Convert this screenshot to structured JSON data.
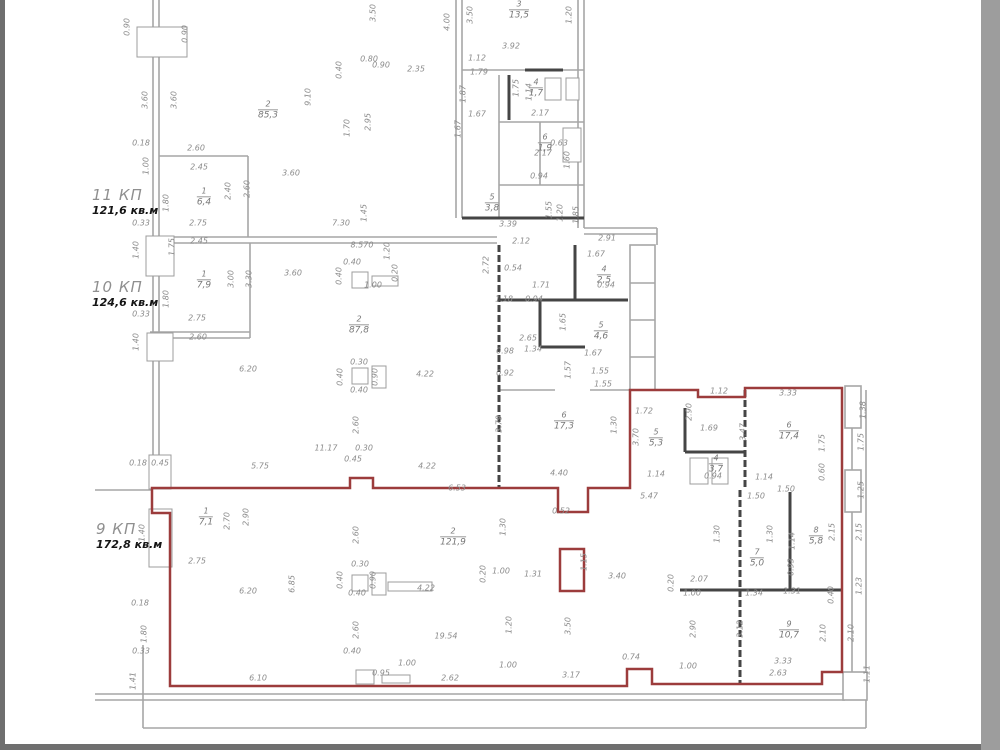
{
  "drawing": {
    "type": "floor-plan",
    "units": "m"
  },
  "colors": {
    "red_wall": "#9c3c3c",
    "gray_wall": "#a6a6a6",
    "black_wall": "#454545",
    "dim_text": "#8b8b8b",
    "room_text": "#787878",
    "apartment_label": "#8f8f8f",
    "apartment_area_text": "#151515",
    "left_bar": "#6f6f6f",
    "right_bar": "#9d9d9d",
    "bottom_bar": "#6f6f6f"
  },
  "apartments": [
    {
      "name": "11 КП",
      "area": "121,6 кв.м",
      "x": 92,
      "y": 186
    },
    {
      "name": "10 КП",
      "area": "124,6 кв.м",
      "x": 92,
      "y": 278
    },
    {
      "name": "9 КП",
      "area": "172,8 кв.м",
      "x": 96,
      "y": 520
    }
  ],
  "rooms": [
    {
      "num": "2",
      "val": "85,3",
      "x": 268,
      "y": 110
    },
    {
      "num": "3",
      "val": "13,5",
      "x": 519,
      "y": 10
    },
    {
      "num": "4",
      "val": "1,7",
      "x": 536,
      "y": 88
    },
    {
      "num": "6",
      "val": "1,9",
      "x": 545,
      "y": 143
    },
    {
      "num": "5",
      "val": "3,8",
      "x": 492,
      "y": 203
    },
    {
      "num": "1",
      "val": "6,4",
      "x": 204,
      "y": 197
    },
    {
      "num": "1",
      "val": "7,9",
      "x": 204,
      "y": 280
    },
    {
      "num": "2",
      "val": "87,8",
      "x": 359,
      "y": 325
    },
    {
      "num": "4",
      "val": "2,5",
      "x": 604,
      "y": 275
    },
    {
      "num": "5",
      "val": "4,6",
      "x": 601,
      "y": 331
    },
    {
      "num": "6",
      "val": "17,3",
      "x": 564,
      "y": 421
    },
    {
      "num": "1",
      "val": "7,1",
      "x": 206,
      "y": 517
    },
    {
      "num": "2",
      "val": "121,9",
      "x": 453,
      "y": 537
    },
    {
      "num": "5",
      "val": "5,3",
      "x": 656,
      "y": 438
    },
    {
      "num": "4",
      "val": "3,7",
      "x": 716,
      "y": 464
    },
    {
      "num": "6",
      "val": "17,4",
      "x": 789,
      "y": 431
    },
    {
      "num": "7",
      "val": "5,0",
      "x": 757,
      "y": 558
    },
    {
      "num": "8",
      "val": "5,8",
      "x": 816,
      "y": 536
    },
    {
      "num": "9",
      "val": "10,7",
      "x": 789,
      "y": 630
    }
  ],
  "dims": [
    {
      "t": "0.90",
      "x": 128,
      "y": 27,
      "r": 90
    },
    {
      "t": "0.90",
      "x": 186,
      "y": 34,
      "r": 90
    },
    {
      "t": "3.60",
      "x": 146,
      "y": 100,
      "r": 90
    },
    {
      "t": "3.60",
      "x": 175,
      "y": 100,
      "r": 90
    },
    {
      "t": "0.18",
      "x": 141,
      "y": 144
    },
    {
      "t": "1.00",
      "x": 147,
      "y": 166,
      "r": 90
    },
    {
      "t": "2.60",
      "x": 196,
      "y": 149
    },
    {
      "t": "2.45",
      "x": 199,
      "y": 168
    },
    {
      "t": "1.80",
      "x": 167,
      "y": 203,
      "r": 90
    },
    {
      "t": "2.40",
      "x": 229,
      "y": 191,
      "r": 90
    },
    {
      "t": "2.60",
      "x": 248,
      "y": 189,
      "r": 90
    },
    {
      "t": "0.33",
      "x": 141,
      "y": 224
    },
    {
      "t": "2.75",
      "x": 198,
      "y": 224
    },
    {
      "t": "3.60",
      "x": 291,
      "y": 174
    },
    {
      "t": "7.30",
      "x": 341,
      "y": 224
    },
    {
      "t": "1.45",
      "x": 365,
      "y": 213,
      "r": 90
    },
    {
      "t": "9.10",
      "x": 309,
      "y": 97,
      "r": 90
    },
    {
      "t": "2.95",
      "x": 369,
      "y": 122,
      "r": 90
    },
    {
      "t": "1.70",
      "x": 348,
      "y": 128,
      "r": 90
    },
    {
      "t": "0.40",
      "x": 340,
      "y": 70,
      "r": 90
    },
    {
      "t": "0.80",
      "x": 369,
      "y": 60
    },
    {
      "t": "0.90",
      "x": 381,
      "y": 66
    },
    {
      "t": "2.35",
      "x": 416,
      "y": 70
    },
    {
      "t": "3.50",
      "x": 374,
      "y": 13,
      "r": 90
    },
    {
      "t": "4.00",
      "x": 448,
      "y": 22,
      "r": 90
    },
    {
      "t": "3.50",
      "x": 471,
      "y": 15,
      "r": 90
    },
    {
      "t": "1.20",
      "x": 570,
      "y": 15,
      "r": 90
    },
    {
      "t": "3.92",
      "x": 511,
      "y": 47
    },
    {
      "t": "1.12",
      "x": 477,
      "y": 59
    },
    {
      "t": "1.79",
      "x": 479,
      "y": 73
    },
    {
      "t": "1.87",
      "x": 464,
      "y": 94,
      "r": 90
    },
    {
      "t": "1.75",
      "x": 517,
      "y": 88,
      "r": 90
    },
    {
      "t": "1.14",
      "x": 530,
      "y": 92,
      "r": 90
    },
    {
      "t": "2.17",
      "x": 540,
      "y": 114
    },
    {
      "t": "1.67",
      "x": 477,
      "y": 115
    },
    {
      "t": "1.67",
      "x": 459,
      "y": 129,
      "r": 90
    },
    {
      "t": "2.17",
      "x": 543,
      "y": 154
    },
    {
      "t": "0.63",
      "x": 559,
      "y": 144
    },
    {
      "t": "1.60",
      "x": 568,
      "y": 160,
      "r": 90
    },
    {
      "t": "0.94",
      "x": 539,
      "y": 177
    },
    {
      "t": "3.39",
      "x": 508,
      "y": 225
    },
    {
      "t": "1.55",
      "x": 550,
      "y": 210,
      "r": 90
    },
    {
      "t": "1.20",
      "x": 561,
      "y": 213,
      "r": 90
    },
    {
      "t": "1.85",
      "x": 577,
      "y": 215,
      "r": 90
    },
    {
      "t": "2.12",
      "x": 521,
      "y": 242
    },
    {
      "t": "2.91",
      "x": 607,
      "y": 239
    },
    {
      "t": "1.40",
      "x": 137,
      "y": 250,
      "r": 90
    },
    {
      "t": "1.75",
      "x": 173,
      "y": 247,
      "r": 90
    },
    {
      "t": "2.45",
      "x": 199,
      "y": 242
    },
    {
      "t": "8.570",
      "x": 362,
      "y": 246
    },
    {
      "t": "0.40",
      "x": 352,
      "y": 263
    },
    {
      "t": "0.40",
      "x": 340,
      "y": 276,
      "r": 90
    },
    {
      "t": "1.00",
      "x": 373,
      "y": 286
    },
    {
      "t": "0.20",
      "x": 396,
      "y": 273,
      "r": 90
    },
    {
      "t": "1.20",
      "x": 388,
      "y": 251,
      "r": 90
    },
    {
      "t": "2.72",
      "x": 487,
      "y": 265,
      "r": 90
    },
    {
      "t": "3.60",
      "x": 293,
      "y": 274
    },
    {
      "t": "1.80",
      "x": 167,
      "y": 299,
      "r": 90
    },
    {
      "t": "3.00",
      "x": 232,
      "y": 279,
      "r": 90
    },
    {
      "t": "3.30",
      "x": 250,
      "y": 279,
      "r": 90
    },
    {
      "t": "2.75",
      "x": 197,
      "y": 319
    },
    {
      "t": "0.33",
      "x": 141,
      "y": 315
    },
    {
      "t": "2.60",
      "x": 198,
      "y": 338
    },
    {
      "t": "1.40",
      "x": 137,
      "y": 342,
      "r": 90
    },
    {
      "t": "1.67",
      "x": 596,
      "y": 255
    },
    {
      "t": "0.94",
      "x": 606,
      "y": 286
    },
    {
      "t": "1.71",
      "x": 541,
      "y": 286
    },
    {
      "t": "1.18",
      "x": 504,
      "y": 300
    },
    {
      "t": "0.94",
      "x": 534,
      "y": 300
    },
    {
      "t": "0.54",
      "x": 513,
      "y": 269
    },
    {
      "t": "1.65",
      "x": 564,
      "y": 322,
      "r": 90
    },
    {
      "t": "2.65",
      "x": 528,
      "y": 339
    },
    {
      "t": "1.34",
      "x": 533,
      "y": 350
    },
    {
      "t": "0.98",
      "x": 505,
      "y": 352
    },
    {
      "t": "0.92",
      "x": 505,
      "y": 374
    },
    {
      "t": "1.67",
      "x": 593,
      "y": 354
    },
    {
      "t": "1.55",
      "x": 600,
      "y": 372
    },
    {
      "t": "1.55",
      "x": 603,
      "y": 385
    },
    {
      "t": "1.57",
      "x": 569,
      "y": 370,
      "r": 90
    },
    {
      "t": "6.20",
      "x": 248,
      "y": 370
    },
    {
      "t": "0.30",
      "x": 359,
      "y": 363
    },
    {
      "t": "0.40",
      "x": 341,
      "y": 377,
      "r": 90
    },
    {
      "t": "0.90",
      "x": 376,
      "y": 377,
      "r": 90
    },
    {
      "t": "0.40",
      "x": 359,
      "y": 391
    },
    {
      "t": "4.22",
      "x": 425,
      "y": 375
    },
    {
      "t": "2.60",
      "x": 357,
      "y": 425,
      "r": 90
    },
    {
      "t": "11.17",
      "x": 326,
      "y": 449
    },
    {
      "t": "0.30",
      "x": 364,
      "y": 449
    },
    {
      "t": "0.45",
      "x": 353,
      "y": 460
    },
    {
      "t": "5.75",
      "x": 260,
      "y": 467
    },
    {
      "t": "4.22",
      "x": 427,
      "y": 467
    },
    {
      "t": "6.53",
      "x": 457,
      "y": 489
    },
    {
      "t": "3.79",
      "x": 500,
      "y": 424,
      "r": 90
    },
    {
      "t": "1.30",
      "x": 615,
      "y": 425,
      "r": 90
    },
    {
      "t": "4.40",
      "x": 559,
      "y": 474
    },
    {
      "t": "0.18",
      "x": 138,
      "y": 464
    },
    {
      "t": "0.45",
      "x": 160,
      "y": 464
    },
    {
      "t": "3.33",
      "x": 788,
      "y": 394
    },
    {
      "t": "1.12",
      "x": 719,
      "y": 392
    },
    {
      "t": "1.72",
      "x": 644,
      "y": 412
    },
    {
      "t": "3.70",
      "x": 637,
      "y": 437,
      "r": 90
    },
    {
      "t": "1.69",
      "x": 709,
      "y": 429
    },
    {
      "t": "3.47",
      "x": 744,
      "y": 432,
      "r": 90
    },
    {
      "t": "1.75",
      "x": 823,
      "y": 443,
      "r": 90
    },
    {
      "t": "2.90",
      "x": 690,
      "y": 412,
      "r": 90
    },
    {
      "t": "1.14",
      "x": 656,
      "y": 475
    },
    {
      "t": "0.94",
      "x": 713,
      "y": 477
    },
    {
      "t": "1.14",
      "x": 764,
      "y": 478
    },
    {
      "t": "0.60",
      "x": 823,
      "y": 472,
      "r": 90
    },
    {
      "t": "1.50",
      "x": 786,
      "y": 490
    },
    {
      "t": "1.38",
      "x": 864,
      "y": 410,
      "r": 90
    },
    {
      "t": "1.75",
      "x": 862,
      "y": 442,
      "r": 90
    },
    {
      "t": "1.25",
      "x": 862,
      "y": 490,
      "r": 90
    },
    {
      "t": "2.15",
      "x": 833,
      "y": 532,
      "r": 90
    },
    {
      "t": "2.15",
      "x": 860,
      "y": 532,
      "r": 90
    },
    {
      "t": "1.23",
      "x": 860,
      "y": 586,
      "r": 90
    },
    {
      "t": "0.40",
      "x": 832,
      "y": 595,
      "r": 90
    },
    {
      "t": "2.70",
      "x": 228,
      "y": 521,
      "r": 90
    },
    {
      "t": "2.90",
      "x": 247,
      "y": 517,
      "r": 90
    },
    {
      "t": "1.40",
      "x": 143,
      "y": 533,
      "r": 90
    },
    {
      "t": "2.75",
      "x": 197,
      "y": 562
    },
    {
      "t": "0.52",
      "x": 561,
      "y": 512
    },
    {
      "t": "1.15",
      "x": 585,
      "y": 562,
      "r": 90
    },
    {
      "t": "1.30",
      "x": 504,
      "y": 527,
      "r": 90
    },
    {
      "t": "2.60",
      "x": 357,
      "y": 535,
      "r": 90
    },
    {
      "t": "1.00",
      "x": 501,
      "y": 572
    },
    {
      "t": "0.20",
      "x": 484,
      "y": 574,
      "r": 90
    },
    {
      "t": "1.31",
      "x": 533,
      "y": 575
    },
    {
      "t": "3.40",
      "x": 617,
      "y": 577
    },
    {
      "t": "4.22",
      "x": 426,
      "y": 589
    },
    {
      "t": "6.20",
      "x": 248,
      "y": 592
    },
    {
      "t": "6.85",
      "x": 293,
      "y": 584,
      "r": 90
    },
    {
      "t": "0.30",
      "x": 360,
      "y": 565
    },
    {
      "t": "0.40",
      "x": 341,
      "y": 580,
      "r": 90
    },
    {
      "t": "0.90",
      "x": 374,
      "y": 580,
      "r": 90
    },
    {
      "t": "0.40",
      "x": 357,
      "y": 594
    },
    {
      "t": "2.60",
      "x": 357,
      "y": 630,
      "r": 90
    },
    {
      "t": "19.54",
      "x": 446,
      "y": 637
    },
    {
      "t": "1.20",
      "x": 510,
      "y": 625,
      "r": 90
    },
    {
      "t": "3.50",
      "x": 569,
      "y": 626,
      "r": 90
    },
    {
      "t": "5.47",
      "x": 649,
      "y": 497
    },
    {
      "t": "1.50",
      "x": 756,
      "y": 497
    },
    {
      "t": "1.30",
      "x": 718,
      "y": 534,
      "r": 90
    },
    {
      "t": "1.30",
      "x": 771,
      "y": 534,
      "r": 90
    },
    {
      "t": "1.14",
      "x": 793,
      "y": 541,
      "r": 90
    },
    {
      "t": "0.93",
      "x": 792,
      "y": 567,
      "r": 90
    },
    {
      "t": "2.07",
      "x": 699,
      "y": 580
    },
    {
      "t": "1.00",
      "x": 692,
      "y": 594
    },
    {
      "t": "1.34",
      "x": 754,
      "y": 594
    },
    {
      "t": "1.31",
      "x": 792,
      "y": 592
    },
    {
      "t": "0.20",
      "x": 672,
      "y": 583,
      "r": 90
    },
    {
      "t": "2.90",
      "x": 694,
      "y": 629,
      "r": 90
    },
    {
      "t": "3.12",
      "x": 741,
      "y": 629,
      "r": 90
    },
    {
      "t": "2.10",
      "x": 824,
      "y": 633,
      "r": 90
    },
    {
      "t": "2.10",
      "x": 852,
      "y": 633,
      "r": 90
    },
    {
      "t": "3.33",
      "x": 783,
      "y": 662
    },
    {
      "t": "2.63",
      "x": 778,
      "y": 674
    },
    {
      "t": "1.11",
      "x": 868,
      "y": 674,
      "r": 90
    },
    {
      "t": "0.74",
      "x": 631,
      "y": 658
    },
    {
      "t": "1.00",
      "x": 688,
      "y": 667
    },
    {
      "t": "6.10",
      "x": 258,
      "y": 679
    },
    {
      "t": "0.40",
      "x": 352,
      "y": 652
    },
    {
      "t": "0.95",
      "x": 381,
      "y": 674
    },
    {
      "t": "1.00",
      "x": 407,
      "y": 664
    },
    {
      "t": "2.62",
      "x": 450,
      "y": 679
    },
    {
      "t": "1.00",
      "x": 508,
      "y": 666
    },
    {
      "t": "3.17",
      "x": 571,
      "y": 676
    },
    {
      "t": "1.41",
      "x": 134,
      "y": 681,
      "r": 90
    },
    {
      "t": "0.18",
      "x": 140,
      "y": 604
    },
    {
      "t": "1.80",
      "x": 145,
      "y": 634,
      "r": 90
    },
    {
      "t": "0.33",
      "x": 141,
      "y": 652
    }
  ]
}
